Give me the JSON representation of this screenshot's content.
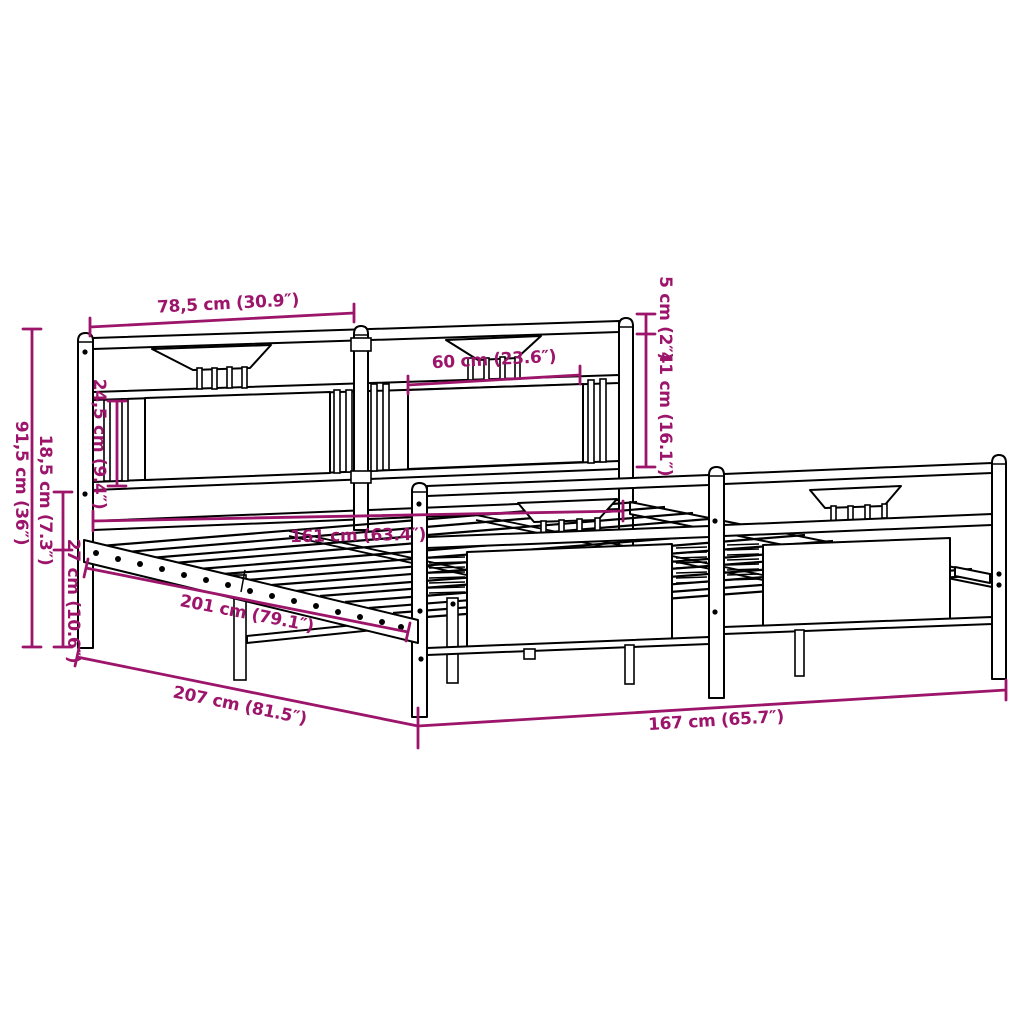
{
  "diagram": {
    "type": "bed-frame-dimension-diagram",
    "accent_color": "#9C156B",
    "line_color": "#000000",
    "background_color": "#FFFFFF",
    "dimensions": {
      "headboard_section_width": "78,5 cm (30.9″)",
      "headboard_inner_width": "60 cm (23.6″)",
      "post_cap_height": "5 cm (2″)",
      "headboard_upper_height": "41 cm (16.1″)",
      "headboard_panel_height": "24,5 cm (9.4″)",
      "headboard_total_height": "91,5 cm (36″)",
      "under_frame_clearance": "18,5 cm (7.3″)",
      "frame_height": "27 cm (10.6″)",
      "slat_area_width": "161 cm (63.4″)",
      "inner_length": "201 cm (79.1″)",
      "total_length": "207 cm (81.5″)",
      "total_width": "167 cm (65.7″)"
    }
  }
}
